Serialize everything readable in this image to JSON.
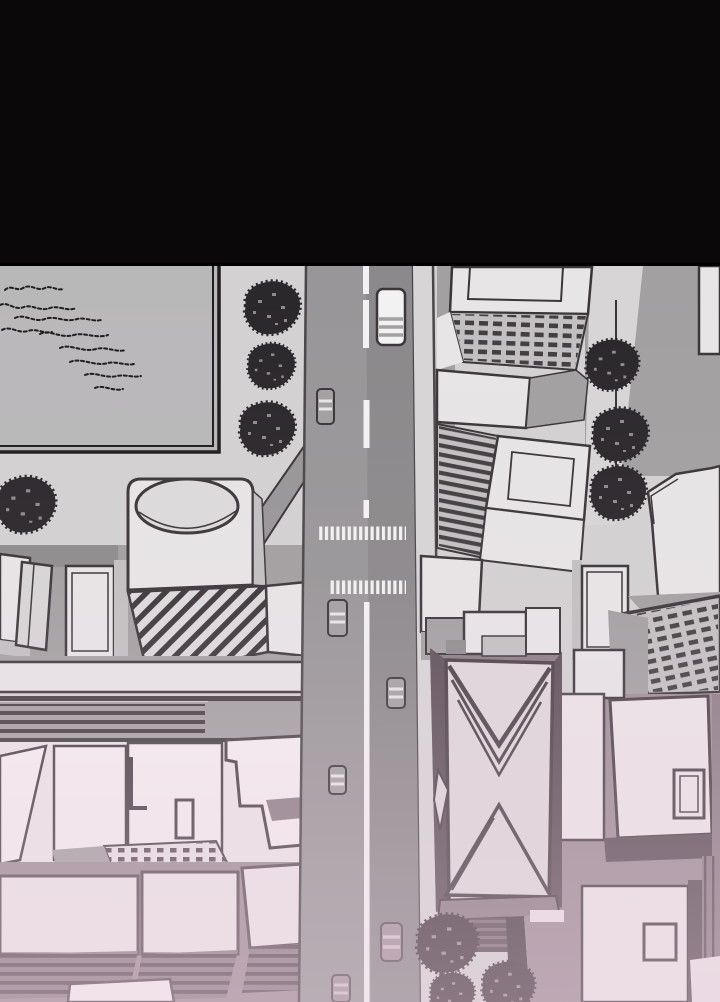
{
  "scene": {
    "type": "comic-panel aerial city illustration",
    "description": "Webtoon-style panel: black letterbox band above a top-down aerial view of a city block with a park, tree-lined avenue, crosswalks, cars, a cylindrical tower, office rooftops and an X-facade skyscraper; the lower half fades into a pink haze",
    "objects": {
      "cars_on_road": 7,
      "street_trees": 7,
      "bottom_trees": 3,
      "crosswalks": 2,
      "landmarks": [
        "park",
        "cylindrical-tower",
        "x-facade-skyscraper",
        "window-grid-offices"
      ]
    }
  },
  "palette": {
    "black_band": "#0b0809",
    "ink": "#3a3539",
    "park_ink": "#1f1d1e",
    "base": "#d3d1d2",
    "park": "#b9b8b9",
    "road": "#989698",
    "road_dark": "#8b898b",
    "curb": "#4a4648",
    "white_line": "#f3f2f2",
    "sidewalk": "#d7d5d6",
    "tree": "#2a272b",
    "tree_speck": "#8d8a8c",
    "bldg_light": "#e7e5e6",
    "bldg_mid": "#c2c0c1",
    "bldg_gray": "#a2a0a1",
    "bldg_dark_side": "#8e8c8d",
    "win_dark": "#413d40",
    "hatch_bg": "#dcdadb",
    "mauve_ground": "#9d8d96",
    "mauve_mid": "#8c7d86",
    "mauve_mid2": "#7c6e76",
    "mauve_dark": "#5c4f57",
    "pink_light": "#e9e0e4",
    "pink_roof": "#ece4e7",
    "pink_white": "#f4edf0",
    "x_face": "#ded7da",
    "x_ink": "#4a4046",
    "tree_mauve": "#473b42",
    "tree_mauve_speck": "#9b8a93",
    "car_mauve": "#a2929b",
    "car_mauve_stripe": "#cfc2c9",
    "overlay_pink": "#eed2e2"
  }
}
